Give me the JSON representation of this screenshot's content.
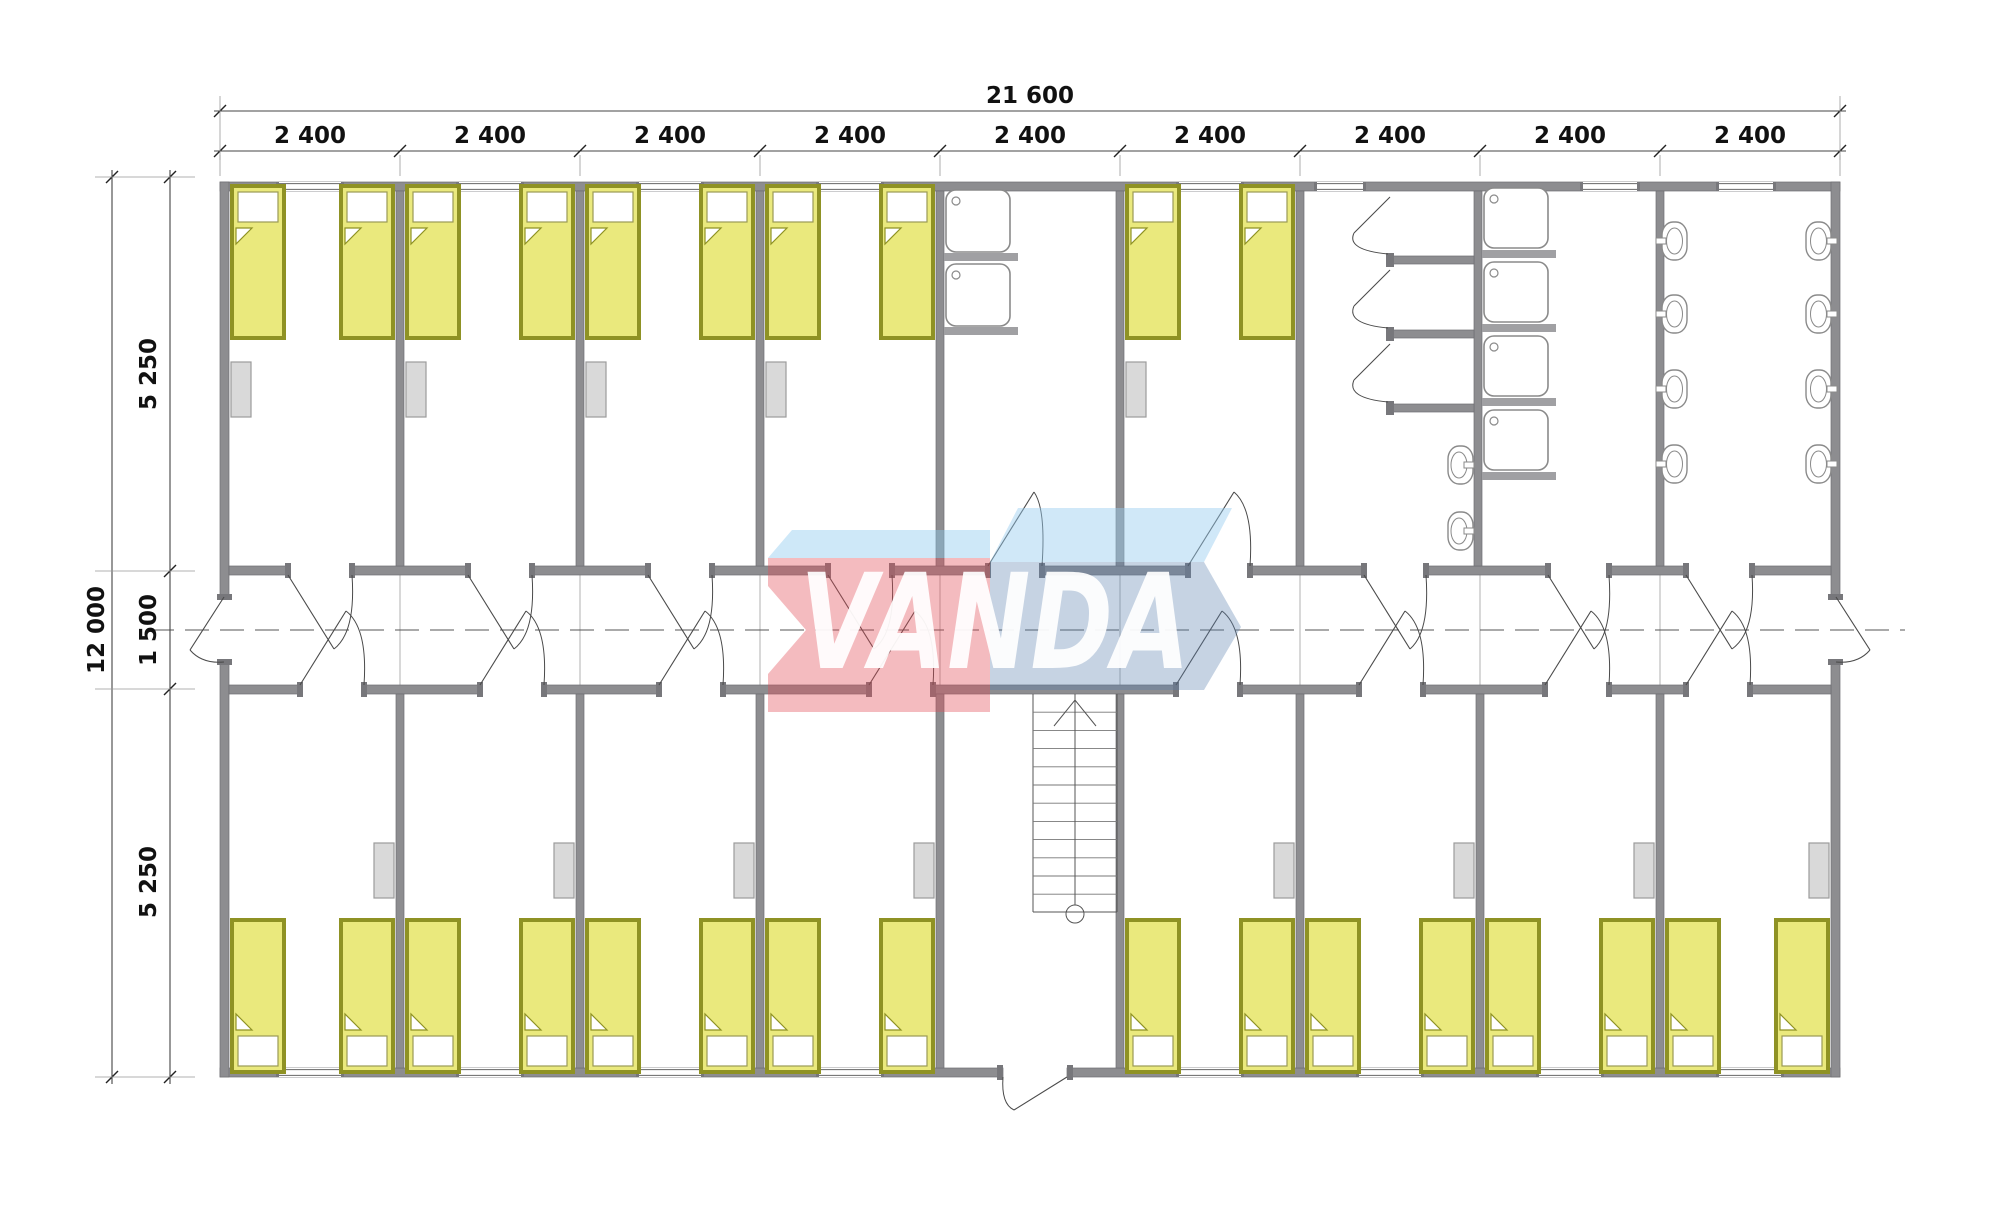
{
  "dimensions": {
    "top_total": "21 600",
    "top_modules": [
      "2 400",
      "2 400",
      "2 400",
      "2 400",
      "2 400",
      "2 400",
      "2 400",
      "2 400",
      "2 400"
    ],
    "left_total": "12 000",
    "left_segments": [
      "5 250",
      "1 500",
      "5 250"
    ]
  },
  "watermark": {
    "text": "VANDA",
    "red_body": "rgba(225,75,88,0.38)",
    "red_top": "rgba(139,201,238,0.42)",
    "blue_body": "rgba(92,130,175,0.35)",
    "blue_top": "rgba(150,205,240,0.45)",
    "text_color": "#ffffff"
  },
  "plan_colors": {
    "wall": "#8d8d90",
    "wall_edge": "#6e6e72",
    "bed_fill": "#eae97d",
    "bed_frame": "#8f9224",
    "pillow": "#ffffff",
    "cabinet": "#d9d9d9",
    "cabinet_edge": "#9b9b9b",
    "fixture_stroke": "#8a8a8a",
    "door_line": "#4a4a4a",
    "axis_line": "#555555"
  },
  "fixtures": {
    "bed": "single-bed-icon",
    "wardrobe": "cabinet-icon",
    "sink": "square-sink-icon",
    "shower": "shower-stall-icon",
    "basin": "washbasin-icon",
    "urinal": "urinal-icon",
    "wc": "toilet-cubicle",
    "stairs": "staircase-up-icon",
    "window": "window-opening",
    "door": "door-swing"
  }
}
